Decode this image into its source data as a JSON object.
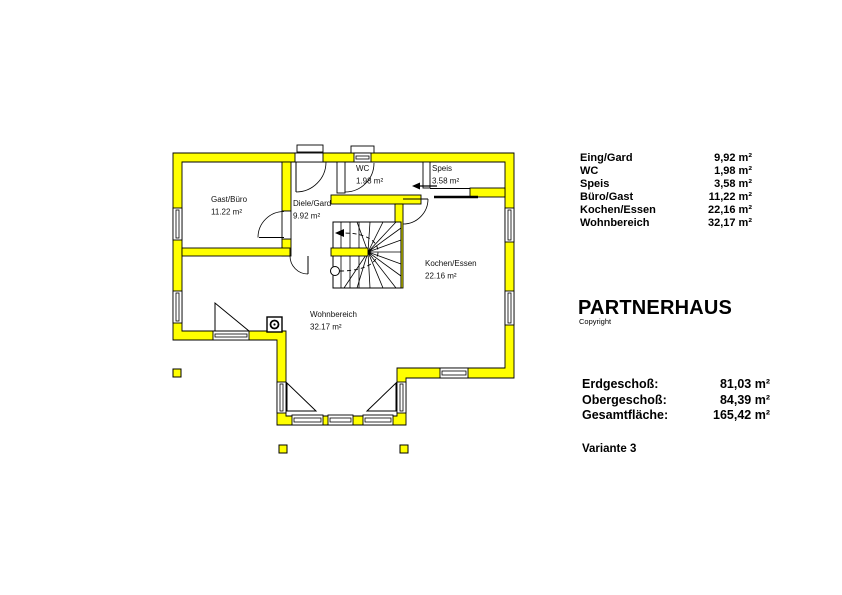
{
  "floor_plan": {
    "wall_color": "#ffff00",
    "rooms": [
      {
        "name": "Gast/Büro",
        "area": "11.22 m²"
      },
      {
        "name": "Diele/Gard",
        "area": "9.92 m²"
      },
      {
        "name": "WC",
        "area": "1.98 m²"
      },
      {
        "name": "Speis",
        "area": "3.58 m²"
      },
      {
        "name": "Kochen/Essen",
        "area": "22.16 m²"
      },
      {
        "name": "Wohnbereich",
        "area": "32.17 m²"
      }
    ]
  },
  "panel": {
    "room_list": [
      {
        "label": "Eing/Gard",
        "value": "9,92 m²"
      },
      {
        "label": "WC",
        "value": "1,98 m²"
      },
      {
        "label": "Speis",
        "value": "3,58 m²"
      },
      {
        "label": "Büro/Gast",
        "value": "11,22 m²"
      },
      {
        "label": "Kochen/Essen",
        "value": "22,16 m²"
      },
      {
        "label": "Wohnbereich",
        "value": "32,17 m²"
      }
    ],
    "title": "PARTNERHAUS",
    "subtitle": "Copyright",
    "totals": [
      {
        "label": "Erdgeschoß:",
        "value": "81,03 m²"
      },
      {
        "label": "Obergeschoß:",
        "value": "84,39 m²"
      },
      {
        "label": "Gesamtfläche:",
        "value": "165,42 m²"
      }
    ],
    "variant": "Variante 3"
  }
}
